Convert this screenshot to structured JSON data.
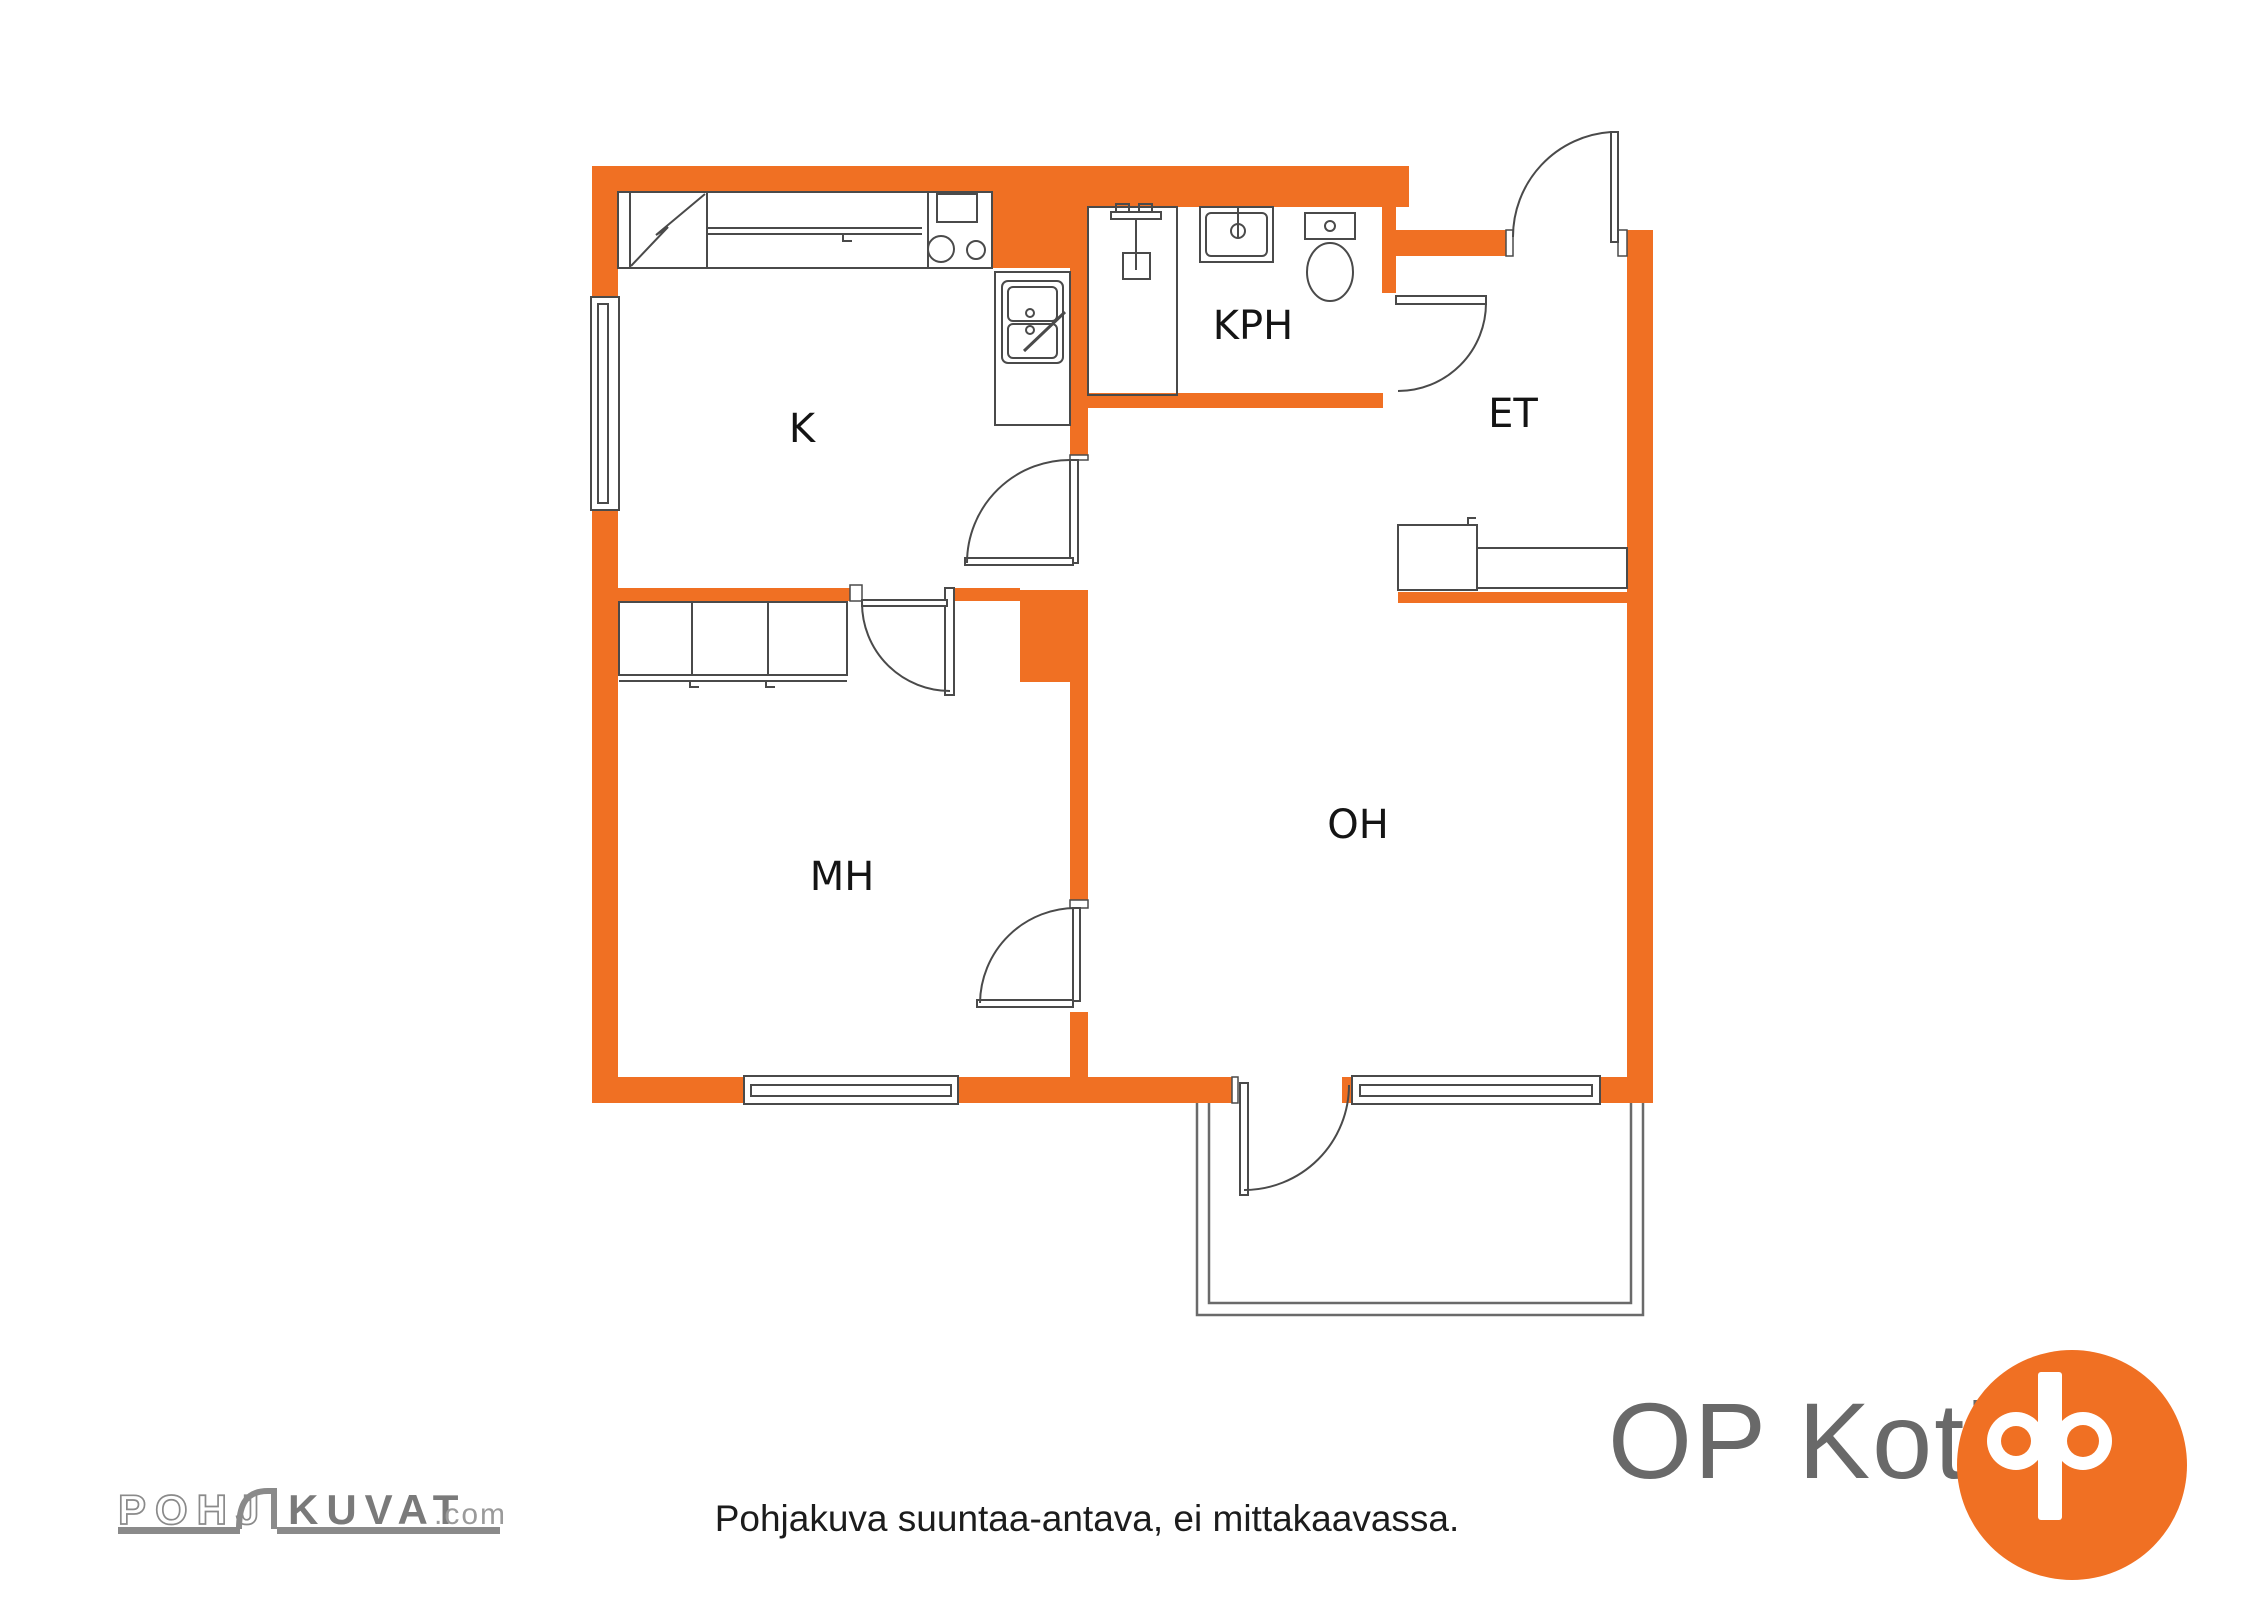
{
  "plan": {
    "rooms": {
      "k": {
        "label": "K"
      },
      "kph": {
        "label": "KPH"
      },
      "et": {
        "label": "ET"
      },
      "mh": {
        "label": "MH"
      },
      "oh": {
        "label": "OH"
      }
    }
  },
  "footer": {
    "disclaimer": "Pohjakuva suuntaa-antava, ei mittakaavassa."
  },
  "branding": {
    "pohjakuvat_part1": "POHJ",
    "pohjakuvat_part2": "KUVAT",
    "pohjakuvat_suffix": ".com",
    "op_koti": "OP Koti"
  },
  "colors": {
    "wall_orange": "#F07023",
    "line_gray": "#4a4a4a",
    "balcony_gray": "#6a6a6a",
    "brand_gray": "#8a8a8a",
    "op_text_gray": "#696969"
  }
}
